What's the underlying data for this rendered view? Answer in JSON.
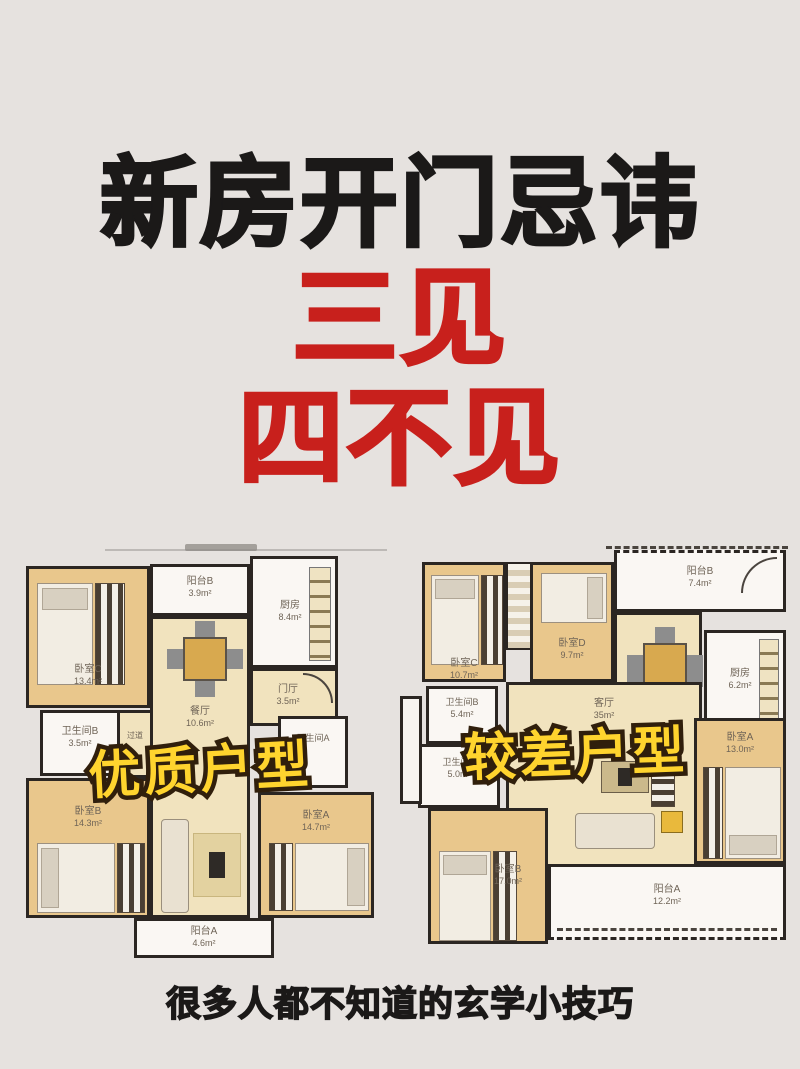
{
  "poster": {
    "title": "新房开门忌讳",
    "highlight_line1": "三见",
    "highlight_line2": "四不见",
    "footer": "很多人都不知道的玄学小技巧"
  },
  "palette": {
    "background": "#E6E2DF",
    "title_black": "#1B1918",
    "highlight_red": "#C8201C",
    "overlay_yellow": "#FFD42E",
    "overlay_outline": "#301F0C",
    "wood_room": "#E9C78C",
    "beige_room": "#F1E3BE",
    "white_room": "#FAF7F3",
    "wall": "#2B2622"
  },
  "plans": [
    {
      "overlay": "优质户型",
      "rooms": [
        {
          "name": "卧室C",
          "area": "13.4m²"
        },
        {
          "name": "阳台B",
          "area": "3.9m²"
        },
        {
          "name": "厨房",
          "area": "8.4m²"
        },
        {
          "name": "餐厅",
          "area": "10.6m²"
        },
        {
          "name": "门厅",
          "area": "3.5m²"
        },
        {
          "name": "卫生间B",
          "area": "3.5m²"
        },
        {
          "name": "过道",
          "area": ""
        },
        {
          "name": "卫生间A",
          "area": ""
        },
        {
          "name": "卧室B",
          "area": "14.3m²"
        },
        {
          "name": "卧室A",
          "area": "14.7m²"
        },
        {
          "name": "阳台A",
          "area": "4.6m²"
        }
      ]
    },
    {
      "overlay": "较差户型",
      "rooms": [
        {
          "name": "卧室C",
          "area": "10.7m²"
        },
        {
          "name": "卧室D",
          "area": "9.7m²"
        },
        {
          "name": "阳台B",
          "area": "7.4m²"
        },
        {
          "name": "厨房",
          "area": "6.2m²"
        },
        {
          "name": "客厅",
          "area": "35m²"
        },
        {
          "name": "卫生间B",
          "area": "5.4m²"
        },
        {
          "name": "卫生间A",
          "area": "5.0m²"
        },
        {
          "name": "卧室B",
          "area": "17.0m²"
        },
        {
          "name": "卧室A",
          "area": "13.0m²"
        },
        {
          "name": "阳台A",
          "area": "12.2m²"
        }
      ]
    }
  ]
}
